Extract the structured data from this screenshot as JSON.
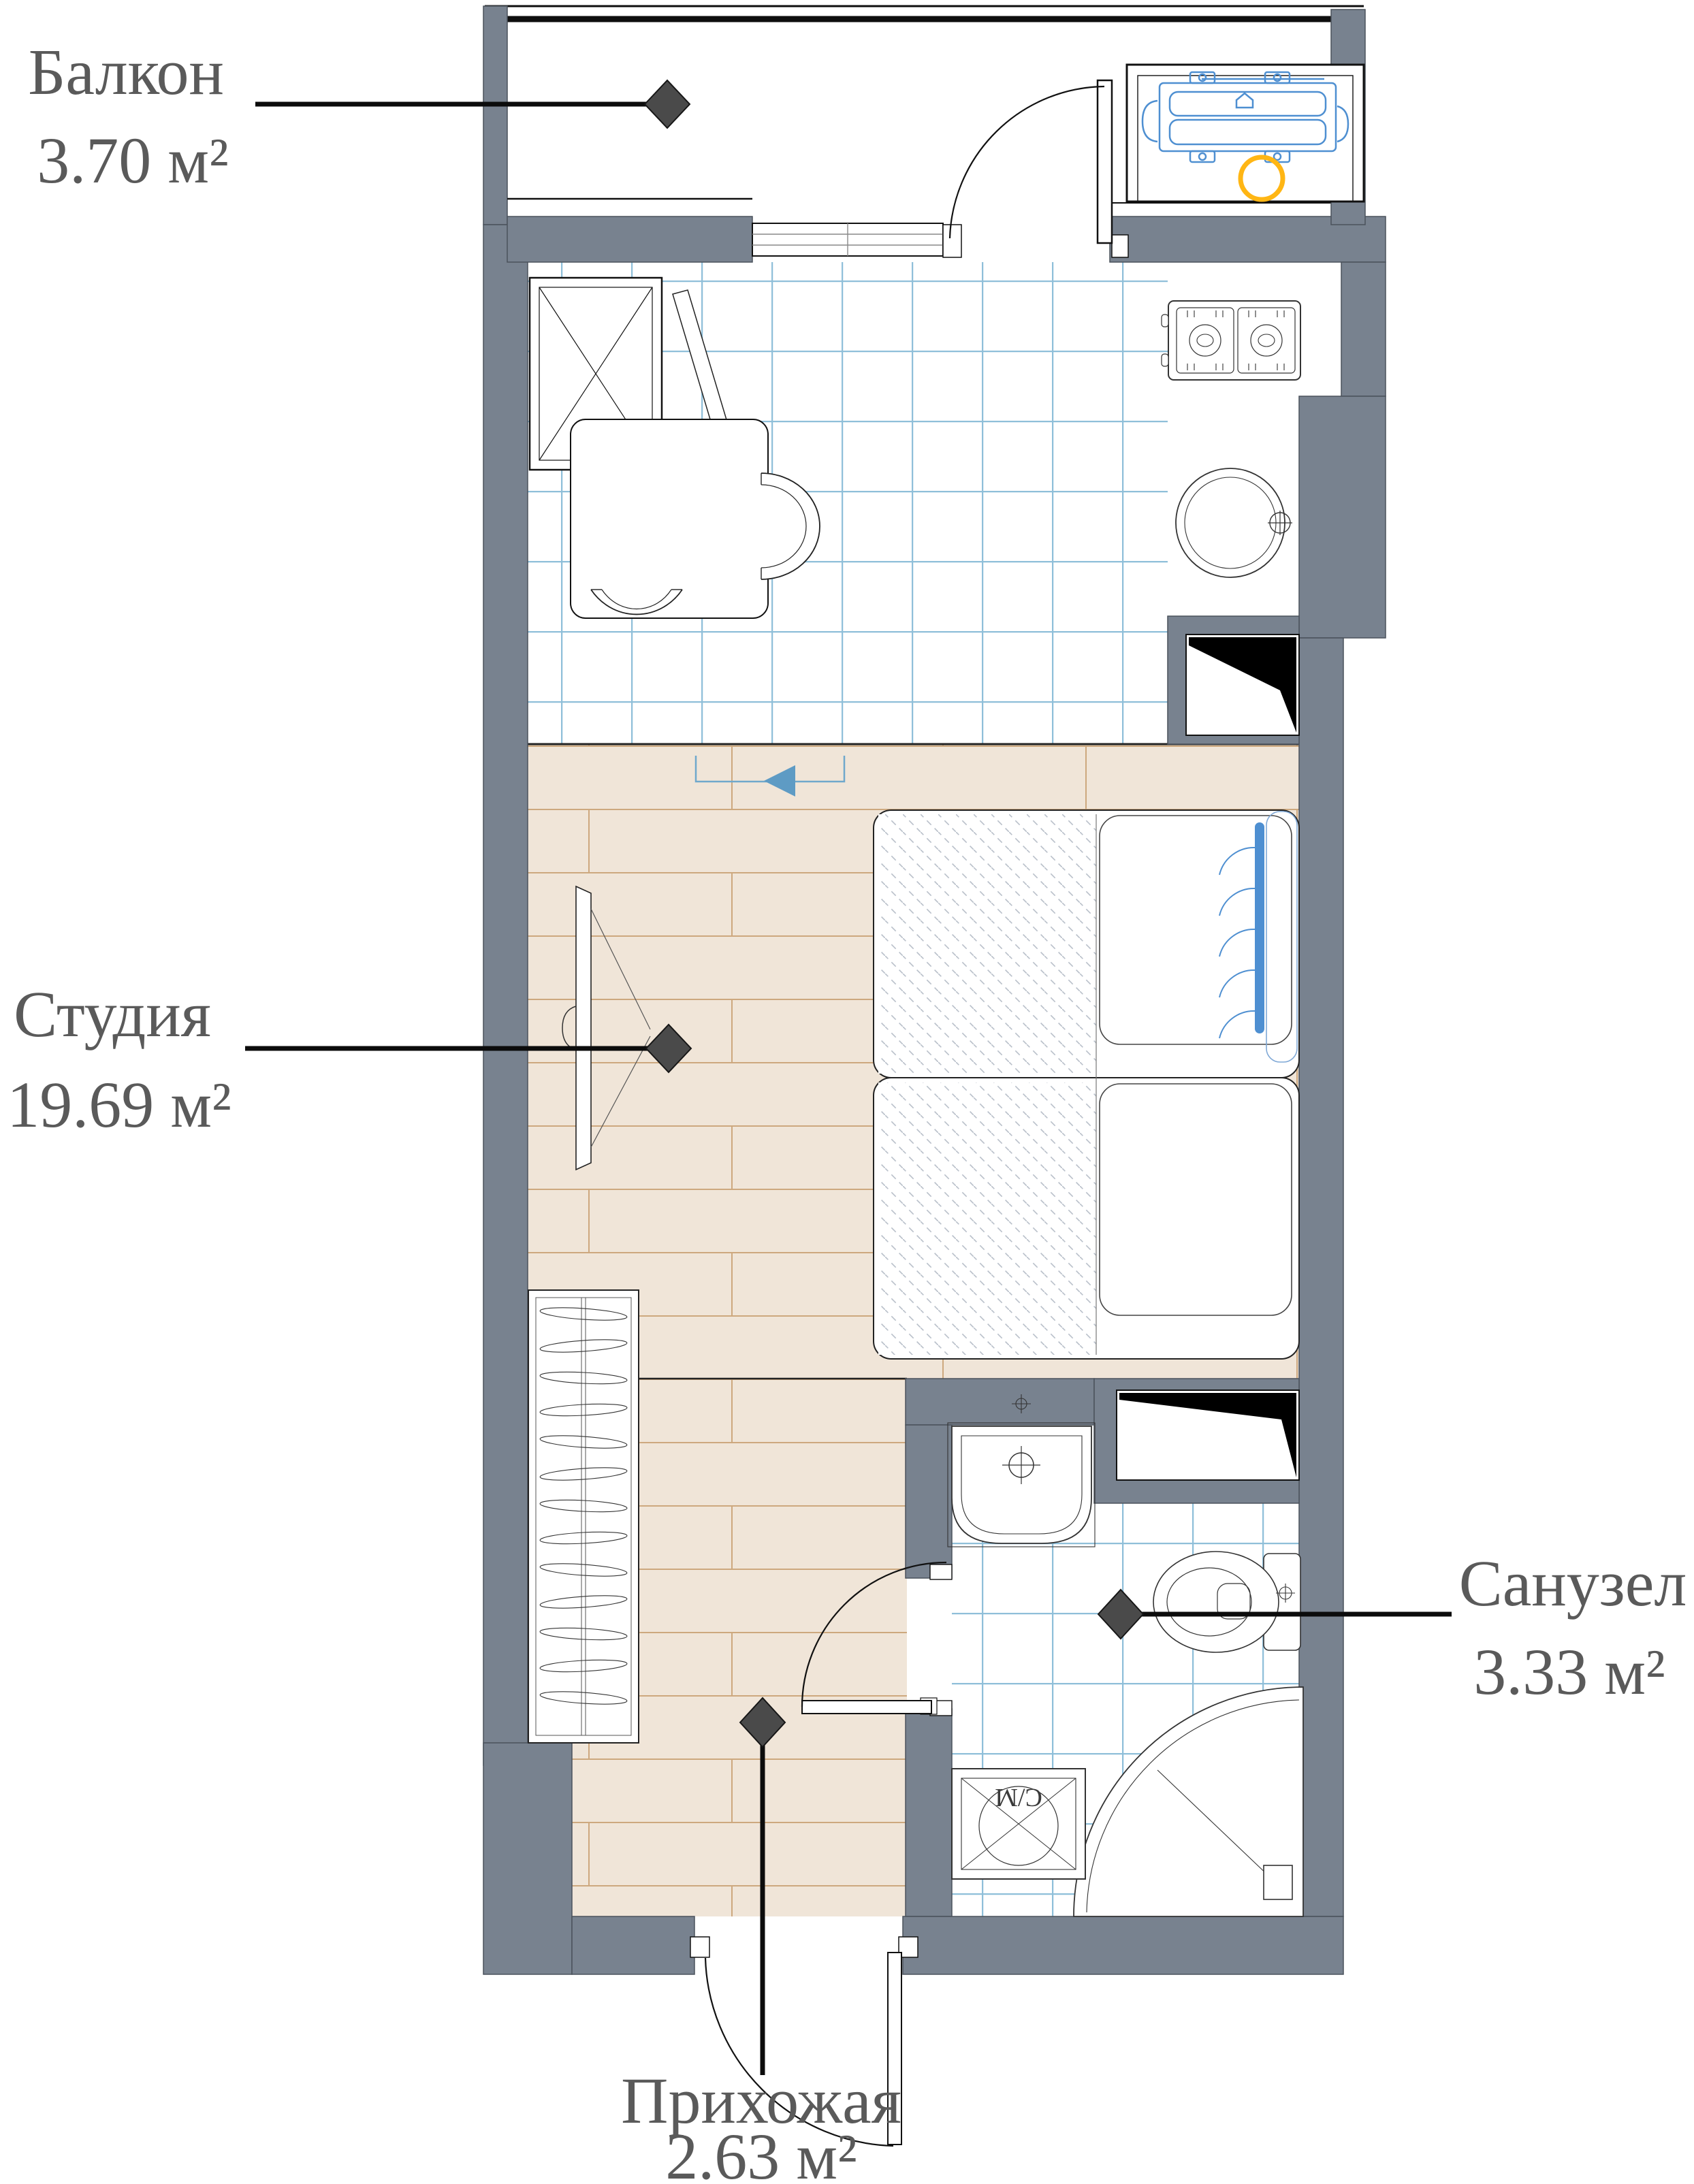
{
  "rooms": {
    "balcony": {
      "name": "Балкон",
      "area": "3.70 м²"
    },
    "studio": {
      "name": "Студия",
      "area": "19.69 м²"
    },
    "bathroom": {
      "name": "Санузел",
      "area": "3.33 м²"
    },
    "hallway": {
      "name": "Прихожая",
      "area": "2.63 м²"
    }
  },
  "appliances": {
    "washing_machine_label": "С/М"
  },
  "colors": {
    "wall": "#78828F",
    "tile_line": "#8FBFD9",
    "wood": "#F0E5D8",
    "wood_line": "#CDA87E",
    "accent_blue": "#4E8FD1",
    "accent_yellow": "#FFB614",
    "marker": "#4A4A4A",
    "label_text": "#5A5A5A"
  }
}
